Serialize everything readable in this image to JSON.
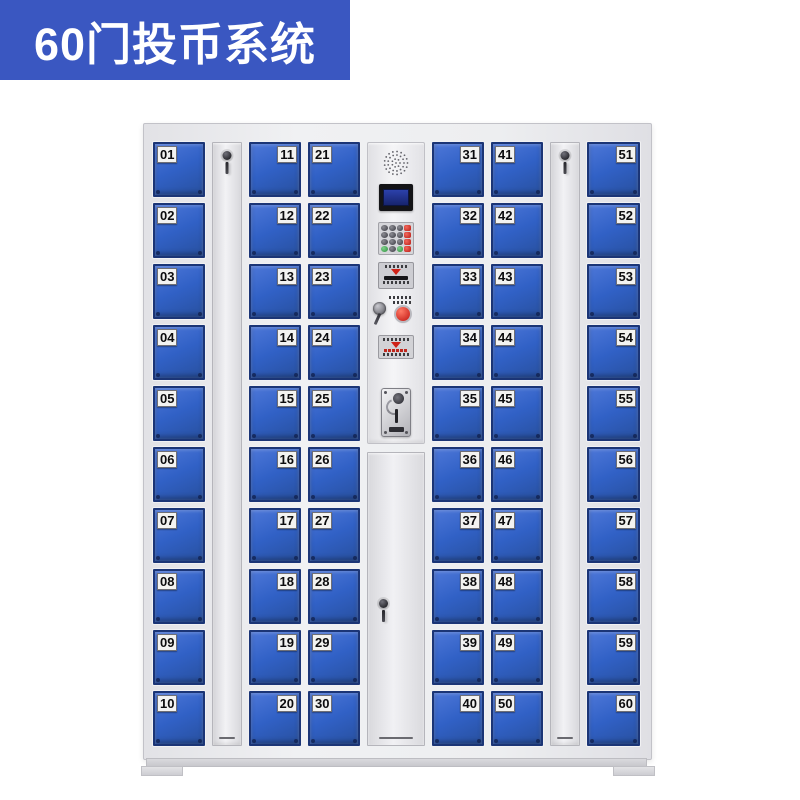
{
  "badge": {
    "label": "60门投币系统"
  },
  "colors": {
    "badge_bg": "#3a57c1",
    "door_blue": "#3161c6",
    "door_border": "#1b3576",
    "cabinet_gray": "#eaeaed",
    "screen_blue": "#223396",
    "red_accent": "#cf2218",
    "green_accent": "#2c8f3e"
  },
  "cabinet": {
    "columns": [
      {
        "type": "doors",
        "label_side": "left",
        "doors": [
          "01",
          "02",
          "03",
          "04",
          "05",
          "06",
          "07",
          "08",
          "09",
          "10"
        ]
      },
      {
        "type": "narrow"
      },
      {
        "type": "doors",
        "label_side": "right",
        "doors": [
          "11",
          "12",
          "13",
          "14",
          "15",
          "16",
          "17",
          "18",
          "19",
          "20"
        ]
      },
      {
        "type": "doors",
        "label_side": "left",
        "doors": [
          "21",
          "22",
          "23",
          "24",
          "25",
          "26",
          "27",
          "28",
          "29",
          "30"
        ]
      },
      {
        "type": "panel"
      },
      {
        "type": "doors",
        "label_side": "right",
        "doors": [
          "31",
          "32",
          "33",
          "34",
          "35",
          "36",
          "37",
          "38",
          "39",
          "40"
        ]
      },
      {
        "type": "doors",
        "label_side": "left",
        "doors": [
          "41",
          "42",
          "43",
          "44",
          "45",
          "46",
          "47",
          "48",
          "49",
          "50"
        ]
      },
      {
        "type": "narrow"
      },
      {
        "type": "doors",
        "label_side": "right",
        "doors": [
          "51",
          "52",
          "53",
          "54",
          "55",
          "56",
          "57",
          "58",
          "59",
          "60"
        ]
      }
    ],
    "panel_keypad": [
      [
        "k",
        "k",
        "k",
        "r"
      ],
      [
        "k",
        "k",
        "k",
        "r"
      ],
      [
        "k",
        "k",
        "k",
        "r"
      ],
      [
        "g",
        "k",
        "g",
        "r"
      ]
    ]
  }
}
